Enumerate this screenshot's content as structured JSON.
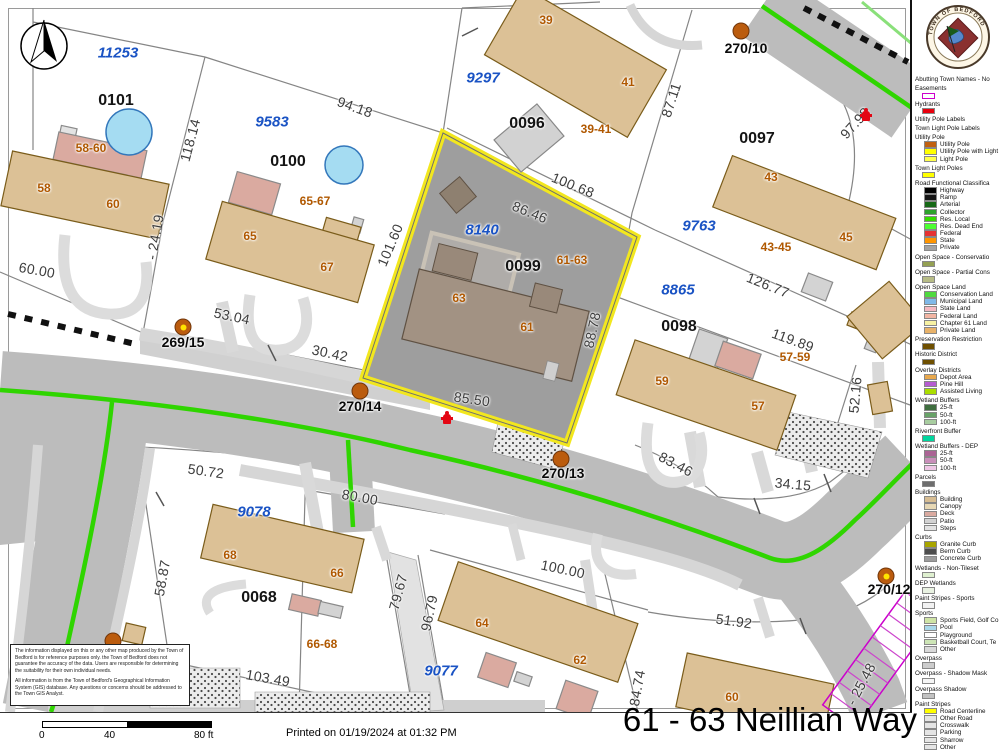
{
  "map": {
    "selected_parcel": {
      "block_id": "0099",
      "address_range": "61-63",
      "abutter_id": "8140"
    },
    "labels": [
      {
        "t": "11253",
        "x": 118,
        "y": 53,
        "r": 0,
        "c": "blue"
      },
      {
        "t": "9583",
        "x": 272,
        "y": 122,
        "r": 0,
        "c": "blue"
      },
      {
        "t": "9297",
        "x": 483,
        "y": 78,
        "r": 0,
        "c": "blue"
      },
      {
        "t": "8140",
        "x": 482,
        "y": 230,
        "r": 0,
        "c": "blue"
      },
      {
        "t": "9763",
        "x": 699,
        "y": 226,
        "r": 0,
        "c": "blue"
      },
      {
        "t": "8865",
        "x": 678,
        "y": 290,
        "r": 0,
        "c": "blue"
      },
      {
        "t": "9078",
        "x": 254,
        "y": 512,
        "r": 0,
        "c": "blue"
      },
      {
        "t": "9077",
        "x": 441,
        "y": 671,
        "r": 0,
        "c": "blue"
      },
      {
        "t": "0101",
        "x": 116,
        "y": 101,
        "r": 0,
        "c": "block"
      },
      {
        "t": "0100",
        "x": 288,
        "y": 162,
        "r": 0,
        "c": "block"
      },
      {
        "t": "0096",
        "x": 527,
        "y": 124,
        "r": 0,
        "c": "block"
      },
      {
        "t": "0097",
        "x": 757,
        "y": 139,
        "r": 0,
        "c": "block"
      },
      {
        "t": "0099",
        "x": 523,
        "y": 267,
        "r": 0,
        "c": "block"
      },
      {
        "t": "0098",
        "x": 679,
        "y": 327,
        "r": 0,
        "c": "block"
      },
      {
        "t": "0068",
        "x": 259,
        "y": 598,
        "r": 0,
        "c": "block"
      },
      {
        "t": "58-60",
        "x": 91,
        "y": 148,
        "r": 0,
        "c": "addr"
      },
      {
        "t": "58",
        "x": 44,
        "y": 188,
        "r": 0,
        "c": "addr"
      },
      {
        "t": "60",
        "x": 113,
        "y": 204,
        "r": 0,
        "c": "addr"
      },
      {
        "t": "65-67",
        "x": 315,
        "y": 201,
        "r": 0,
        "c": "addr"
      },
      {
        "t": "65",
        "x": 250,
        "y": 236,
        "r": 0,
        "c": "addr"
      },
      {
        "t": "67",
        "x": 327,
        "y": 267,
        "r": 0,
        "c": "addr"
      },
      {
        "t": "39",
        "x": 546,
        "y": 20,
        "r": 0,
        "c": "addr"
      },
      {
        "t": "41",
        "x": 628,
        "y": 82,
        "r": 0,
        "c": "addr"
      },
      {
        "t": "39-41",
        "x": 596,
        "y": 129,
        "r": 0,
        "c": "addr"
      },
      {
        "t": "43",
        "x": 771,
        "y": 177,
        "r": 0,
        "c": "addr"
      },
      {
        "t": "45",
        "x": 846,
        "y": 237,
        "r": 0,
        "c": "addr"
      },
      {
        "t": "43-45",
        "x": 776,
        "y": 247,
        "r": 0,
        "c": "addr"
      },
      {
        "t": "61-63",
        "x": 572,
        "y": 260,
        "r": 0,
        "c": "addr"
      },
      {
        "t": "63",
        "x": 459,
        "y": 298,
        "r": 0,
        "c": "addr"
      },
      {
        "t": "61",
        "x": 527,
        "y": 327,
        "r": 0,
        "c": "addr"
      },
      {
        "t": "57-59",
        "x": 795,
        "y": 357,
        "r": 0,
        "c": "addr"
      },
      {
        "t": "59",
        "x": 662,
        "y": 381,
        "r": 0,
        "c": "addr"
      },
      {
        "t": "57",
        "x": 758,
        "y": 406,
        "r": 0,
        "c": "addr"
      },
      {
        "t": "68",
        "x": 230,
        "y": 555,
        "r": 0,
        "c": "addr"
      },
      {
        "t": "66",
        "x": 337,
        "y": 573,
        "r": 0,
        "c": "addr"
      },
      {
        "t": "66-68",
        "x": 322,
        "y": 644,
        "r": 0,
        "c": "addr"
      },
      {
        "t": "64",
        "x": 482,
        "y": 623,
        "r": 0,
        "c": "addr"
      },
      {
        "t": "62",
        "x": 580,
        "y": 660,
        "r": 0,
        "c": "addr"
      },
      {
        "t": "60",
        "x": 732,
        "y": 697,
        "r": 0,
        "c": "addr"
      },
      {
        "t": "270/10",
        "x": 746,
        "y": 48,
        "r": 0,
        "c": "pole"
      },
      {
        "t": "269/15",
        "x": 183,
        "y": 342,
        "r": 0,
        "c": "pole"
      },
      {
        "t": "270/14",
        "x": 360,
        "y": 406,
        "r": 0,
        "c": "pole"
      },
      {
        "t": "270/13",
        "x": 563,
        "y": 473,
        "r": 0,
        "c": "pole"
      },
      {
        "t": "270/12",
        "x": 889,
        "y": 589,
        "r": 0,
        "c": "pole"
      },
      {
        "t": "94.18",
        "x": 355,
        "y": 107,
        "r": 20,
        "c": "dim"
      },
      {
        "t": "118.14",
        "x": 190,
        "y": 140,
        "r": -75,
        "c": "dim"
      },
      {
        "t": "87.11",
        "x": 671,
        "y": 100,
        "r": -72,
        "c": "dim"
      },
      {
        "t": "97.98",
        "x": 855,
        "y": 123,
        "r": -48,
        "c": "dim"
      },
      {
        "t": "100.68",
        "x": 573,
        "y": 185,
        "r": 22,
        "c": "dim"
      },
      {
        "t": "86.46",
        "x": 530,
        "y": 212,
        "r": 22,
        "c": "dim"
      },
      {
        "t": "101.60",
        "x": 390,
        "y": 245,
        "r": -67,
        "c": "dim"
      },
      {
        "t": "88.78",
        "x": 592,
        "y": 330,
        "r": -78,
        "c": "dim"
      },
      {
        "t": "85.50",
        "x": 472,
        "y": 399,
        "r": 8,
        "c": "dim"
      },
      {
        "t": "126.77",
        "x": 768,
        "y": 285,
        "r": 22,
        "c": "dim"
      },
      {
        "t": "119.89",
        "x": 793,
        "y": 340,
        "r": 20,
        "c": "dim"
      },
      {
        "t": "60.00",
        "x": 37,
        "y": 270,
        "r": 10,
        "c": "dim"
      },
      {
        "t": "- 24.19",
        "x": 155,
        "y": 237,
        "r": -80,
        "c": "dim"
      },
      {
        "t": "53.04",
        "x": 232,
        "y": 316,
        "r": 12,
        "c": "dim"
      },
      {
        "t": "30.42",
        "x": 330,
        "y": 353,
        "r": 12,
        "c": "dim"
      },
      {
        "t": "83.46",
        "x": 676,
        "y": 464,
        "r": 28,
        "c": "dim"
      },
      {
        "t": "34.15",
        "x": 793,
        "y": 484,
        "r": 5,
        "c": "dim"
      },
      {
        "t": "52.16",
        "x": 855,
        "y": 395,
        "r": -85,
        "c": "dim"
      },
      {
        "t": "50.72",
        "x": 206,
        "y": 471,
        "r": 8,
        "c": "dim"
      },
      {
        "t": "58.87",
        "x": 162,
        "y": 578,
        "r": -80,
        "c": "dim"
      },
      {
        "t": "80.00",
        "x": 360,
        "y": 497,
        "r": 10,
        "c": "dim"
      },
      {
        "t": "79.67",
        "x": 398,
        "y": 592,
        "r": -75,
        "c": "dim"
      },
      {
        "t": "96.79",
        "x": 429,
        "y": 613,
        "r": -78,
        "c": "dim"
      },
      {
        "t": "103.49",
        "x": 268,
        "y": 678,
        "r": 10,
        "c": "dim"
      },
      {
        "t": "100.00",
        "x": 563,
        "y": 569,
        "r": 12,
        "c": "dim"
      },
      {
        "t": "84.74",
        "x": 637,
        "y": 688,
        "r": -80,
        "c": "dim"
      },
      {
        "t": "51.92",
        "x": 734,
        "y": 621,
        "r": 8,
        "c": "dim"
      },
      {
        "t": "- 25.48",
        "x": 861,
        "y": 684,
        "r": -62,
        "c": "dim"
      }
    ],
    "poles": [
      {
        "x": 741,
        "y": 31,
        "light": false
      },
      {
        "x": 183,
        "y": 327,
        "light": true
      },
      {
        "x": 360,
        "y": 391,
        "light": false
      },
      {
        "x": 561,
        "y": 459,
        "light": false
      },
      {
        "x": 886,
        "y": 576,
        "light": true
      },
      {
        "x": 113,
        "y": 641,
        "light": false
      }
    ],
    "hydrants": [
      {
        "x": 447,
        "y": 418
      },
      {
        "x": 866,
        "y": 115
      }
    ]
  },
  "legend": {
    "sections": [
      {
        "h": "Abutting Town Names - No"
      },
      {
        "h": "Easements",
        "sw": "#ffffff",
        "bd": "#cc00cc"
      },
      {
        "h": "Hydrants",
        "sw": "#e8000d"
      },
      {
        "h": "Utility Pole Labels"
      },
      {
        "h": "Town Light Pole Labels"
      },
      {
        "h": "Utility Pole",
        "items": [
          {
            "label": "Utility Pole",
            "color": "#c06010"
          },
          {
            "label": "Utility Pole with Light",
            "color": "#ffff00"
          },
          {
            "label": "Light Pole",
            "color": "#ffff4d"
          }
        ]
      },
      {
        "h": "Town Light Poles",
        "sw": "#ffff00"
      },
      {
        "h": "Road Functional Classifica",
        "items": [
          {
            "label": "Highway",
            "color": "#000000"
          },
          {
            "label": "Ramp",
            "color": "#141414"
          },
          {
            "label": "Arterial",
            "color": "#166816"
          },
          {
            "label": "Collector",
            "color": "#2da32d"
          },
          {
            "label": "Res. Local",
            "color": "#35dd00"
          },
          {
            "label": "Res. Dead End",
            "color": "#4dff33"
          },
          {
            "label": "Federal",
            "color": "#e63232"
          },
          {
            "label": "State",
            "color": "#ff9500"
          },
          {
            "label": "Private",
            "color": "#a3a3a3"
          }
        ]
      },
      {
        "h": "Open Space - Conservatio",
        "sw": "#94a053"
      },
      {
        "h": "Open Space - Partial Cons",
        "sw": "#b7bc86"
      },
      {
        "h": "Open Space Land",
        "items": [
          {
            "label": "Conservation Land",
            "color": "#4fd93f"
          },
          {
            "label": "Municipal Land",
            "color": "#7fb9e8"
          },
          {
            "label": "State Land",
            "color": "#f5b9c2"
          },
          {
            "label": "Federal Land",
            "color": "#f2b5a3"
          },
          {
            "label": "Chapter 61 Land",
            "color": "#f7f2a3"
          },
          {
            "label": "Private Land",
            "color": "#e8b269"
          }
        ]
      },
      {
        "h": "Preservation Restriction",
        "sw": "#6e4f00"
      },
      {
        "h": "Historic District",
        "sw": "#6e4f00"
      },
      {
        "h": "Overlay Districts",
        "items": [
          {
            "label": "Depot Area",
            "color": "#e8a84d"
          },
          {
            "label": "Pine Hill",
            "color": "#b55cd1"
          },
          {
            "label": "Assisted Living",
            "color": "#aade00"
          }
        ]
      },
      {
        "h": "Wetland Buffers",
        "items": [
          {
            "label": "25-ft",
            "color": "#3f6e3f"
          },
          {
            "label": "50-ft",
            "color": "#69a369"
          },
          {
            "label": "100-ft",
            "color": "#a8cda0"
          }
        ]
      },
      {
        "h": "Riverfront Buffer",
        "sw": "#00d69e"
      },
      {
        "h": "Wetland Buffers - DEP",
        "items": [
          {
            "label": "25-ft",
            "color": "#ab6495"
          },
          {
            "label": "50-ft",
            "color": "#c98fba"
          },
          {
            "label": "100-ft",
            "color": "#efc7e6"
          }
        ]
      },
      {
        "h": "Parcels",
        "sw": "#6e6e6e"
      },
      {
        "h": "Buildings",
        "items": [
          {
            "label": "Building",
            "color": "#d7bd93"
          },
          {
            "label": "Canopy",
            "color": "#e7d8b5"
          },
          {
            "label": "Deck",
            "color": "#daaaa0"
          },
          {
            "label": "Patio",
            "color": "#d3d3d3"
          },
          {
            "label": "Steps",
            "color": "#e3e3e3"
          }
        ]
      },
      {
        "h": "Curbs",
        "items": [
          {
            "label": "Granite Curb",
            "color": "#a8a500"
          },
          {
            "label": "Berm Curb",
            "color": "#4d4d4d"
          },
          {
            "label": "Concrete Curb",
            "color": "#9c9c9c"
          }
        ]
      },
      {
        "h": "Wetlands - Non-Tileset",
        "sw": "#dff0d0"
      },
      {
        "h": "DEP Wetlands",
        "sw": "#e9f2e2"
      },
      {
        "h": "Paint Stripes - Sports",
        "sw": "#f2f2f2"
      },
      {
        "h": "Sports",
        "items": [
          {
            "label": "Sports Field, Golf Co",
            "color": "#cfe4a6"
          },
          {
            "label": "Pool",
            "color": "#a9d8ea"
          },
          {
            "label": "Playground",
            "color": "#ffffff",
            "pattern": "playground"
          },
          {
            "label": "Basketball Court, Te",
            "color": "#cde5b6"
          },
          {
            "label": "Other",
            "color": "#d9d9d9"
          }
        ]
      },
      {
        "h": "Overpass",
        "sw": "#cccccc"
      },
      {
        "h": "Overpass - Shadow Mask",
        "sw": "#f5f5f5"
      },
      {
        "h": "Overpass Shadow",
        "sw": "#c2c2c2"
      },
      {
        "h": "Paint Stripes",
        "items": [
          {
            "label": "Road Centerline",
            "color": "#ffff00"
          },
          {
            "label": "Other Road",
            "color": "#e5e5e5"
          },
          {
            "label": "Crosswalk",
            "color": "#e5e5e5"
          },
          {
            "label": "Parking",
            "color": "#e5e5e5"
          },
          {
            "label": "Sharrow",
            "color": "#e5e5e5"
          },
          {
            "label": "Other",
            "color": "#e5e5e5"
          }
        ]
      }
    ]
  },
  "seal": {
    "text": "TOWN OF BEDFORD"
  },
  "disclaimer": {
    "p1": "The information displayed on this or any other map produced by the Town of Bedford is for reference purposes only.  the Town of Bedford does not guarantee the accuracy of the data.  Users are responsible for determining the suitability for their own individual needs.",
    "p2": "All information is from the Town of Bedford's Geographical Information System (GIS) database.  Any questions or concerns should be addressed to the Town GIS Analyst."
  },
  "footer": {
    "scale": {
      "t0": "0",
      "t1": "40",
      "t2": "80 ft"
    },
    "printed": "Printed on 01/19/2024  at 01:32 PM",
    "title": "61 - 63 Neillian Way"
  },
  "colors": {
    "selected_parcel_outline": "#f2e71e",
    "selected_parcel_fill": "#9e9e9e",
    "road": "#bcbcbc",
    "centerline_green": "#2fd500",
    "building_tan": "#dcc196",
    "easement_magenta": "#cc00cc"
  }
}
